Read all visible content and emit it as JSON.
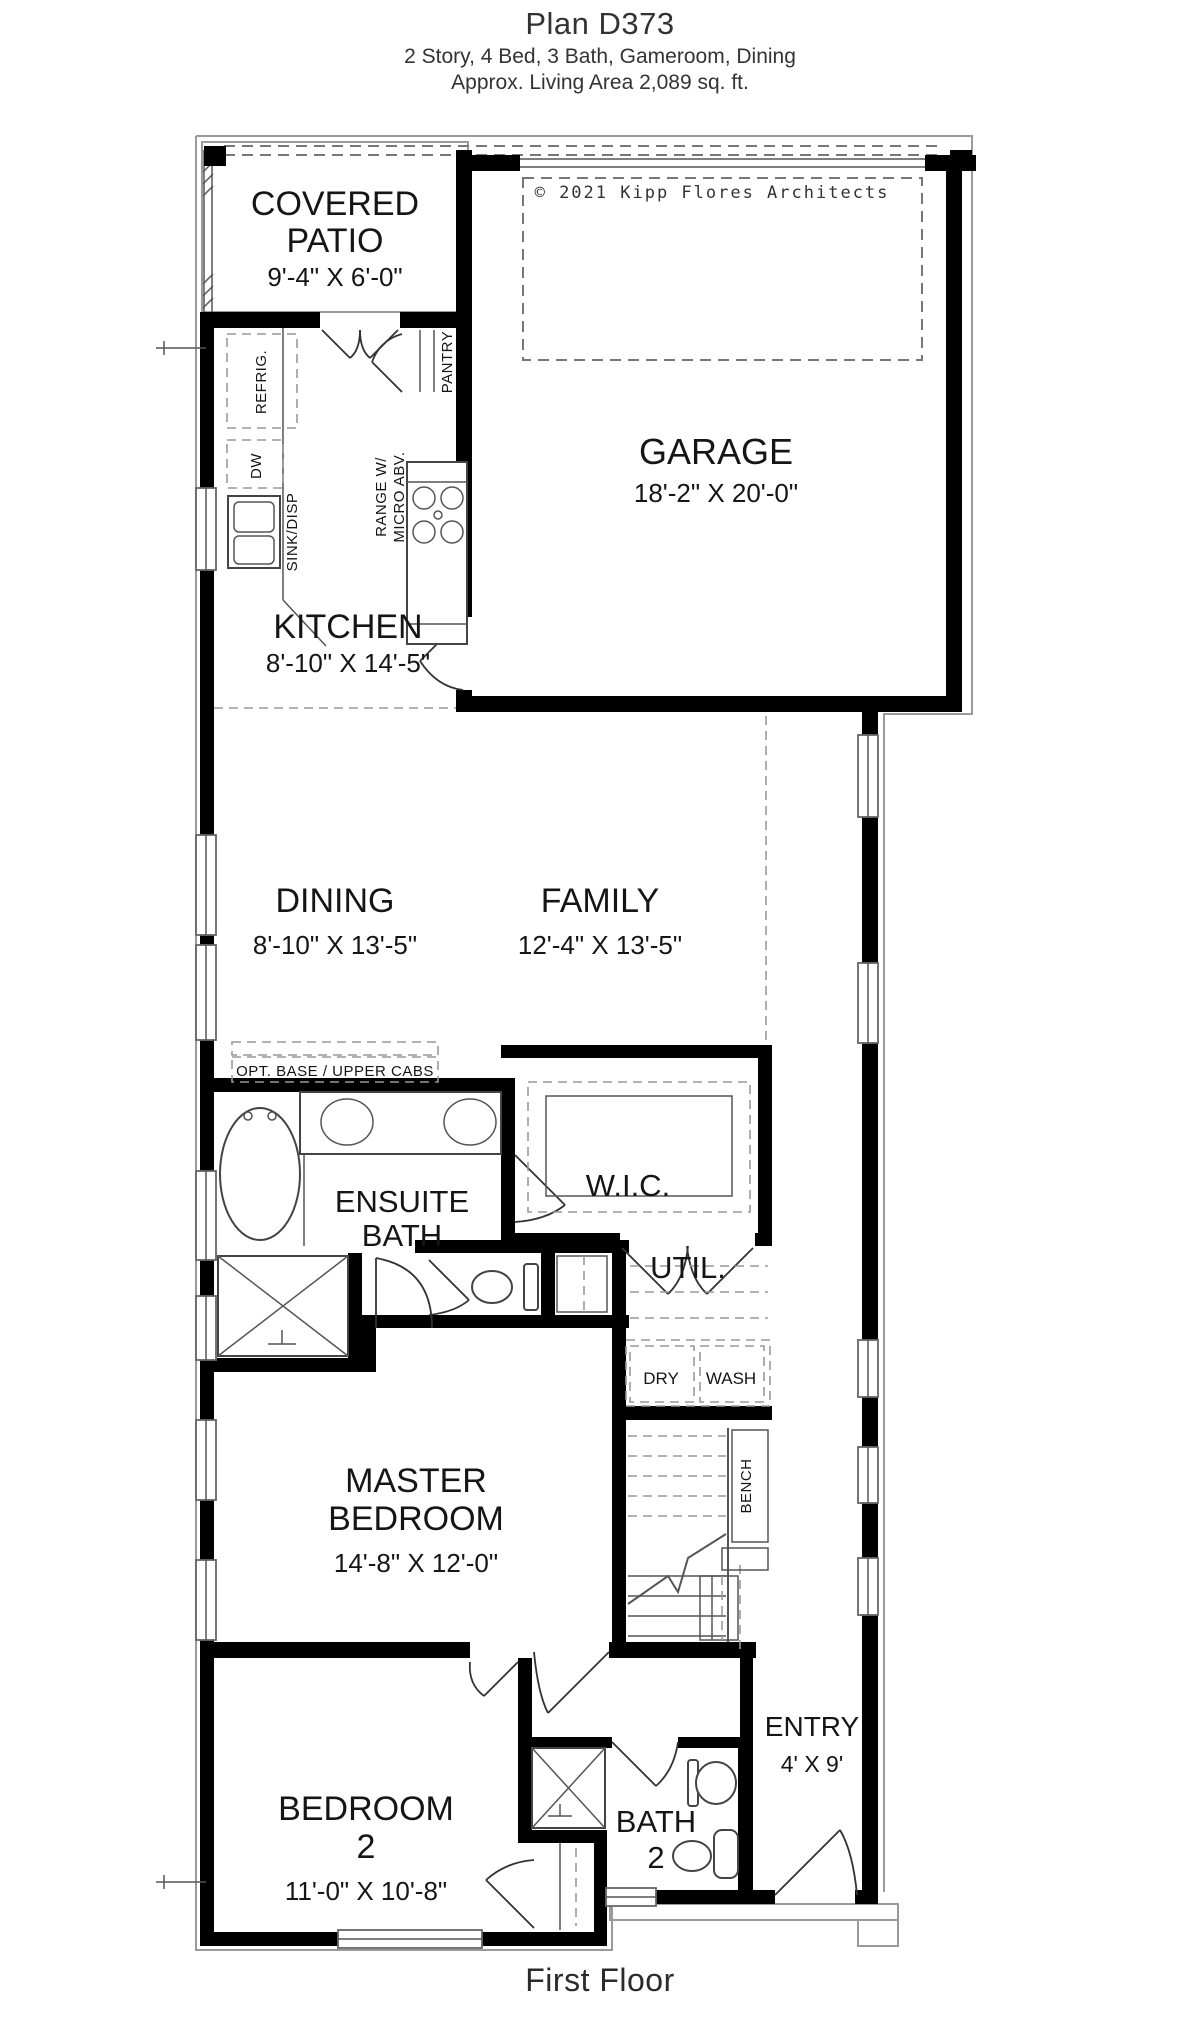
{
  "header": {
    "title": "Plan D373",
    "subtitle": "2 Story, 4 Bed, 3 Bath, Gameroom, Dining",
    "area_line": "Approx. Living Area 2,089 sq. ft."
  },
  "copyright": "© 2021 Kipp Flores Architects",
  "footer": {
    "label": "First Floor"
  },
  "rooms": {
    "covered_patio": {
      "line1": "COVERED",
      "line2": "PATIO",
      "dims": "9'-4\" X 6'-0\""
    },
    "garage": {
      "line1": "GARAGE",
      "dims": "18'-2\" X 20'-0\""
    },
    "kitchen": {
      "line1": "KITCHEN",
      "dims": "8'-10\" X 14'-5\""
    },
    "dining": {
      "line1": "DINING",
      "dims": "8'-10\" X 13'-5\""
    },
    "family": {
      "line1": "FAMILY",
      "dims": "12'-4\" X 13'-5\""
    },
    "ensuite_bath": {
      "line1": "ENSUITE",
      "line2": "BATH"
    },
    "wic": {
      "line1": "W.I.C."
    },
    "util": {
      "line1": "UTIL."
    },
    "master_bedroom": {
      "line1": "MASTER",
      "line2": "BEDROOM",
      "dims": "14'-8\" X 12'-0\""
    },
    "bedroom2": {
      "line1": "BEDROOM",
      "line2": "2",
      "dims": "11'-0\" X 10'-8\""
    },
    "bath2": {
      "line1": "BATH",
      "line2": "2"
    },
    "entry": {
      "line1": "ENTRY",
      "dims": "4' X 9'"
    }
  },
  "labels": {
    "refrig": "REFRIG.",
    "dw": "DW",
    "sink_disp": "SINK/DISP",
    "pantry": "PANTRY",
    "range_line1": "RANGE W/",
    "range_line2": "MICRO ABV.",
    "opt_cabs": "OPT. BASE / UPPER CABS",
    "dry": "DRY",
    "wash": "WASH",
    "bench": "BENCH"
  },
  "colors": {
    "ink": "#151515",
    "wall": "#000000",
    "thin_line": "#555555",
    "dashed_line": "#777777"
  }
}
